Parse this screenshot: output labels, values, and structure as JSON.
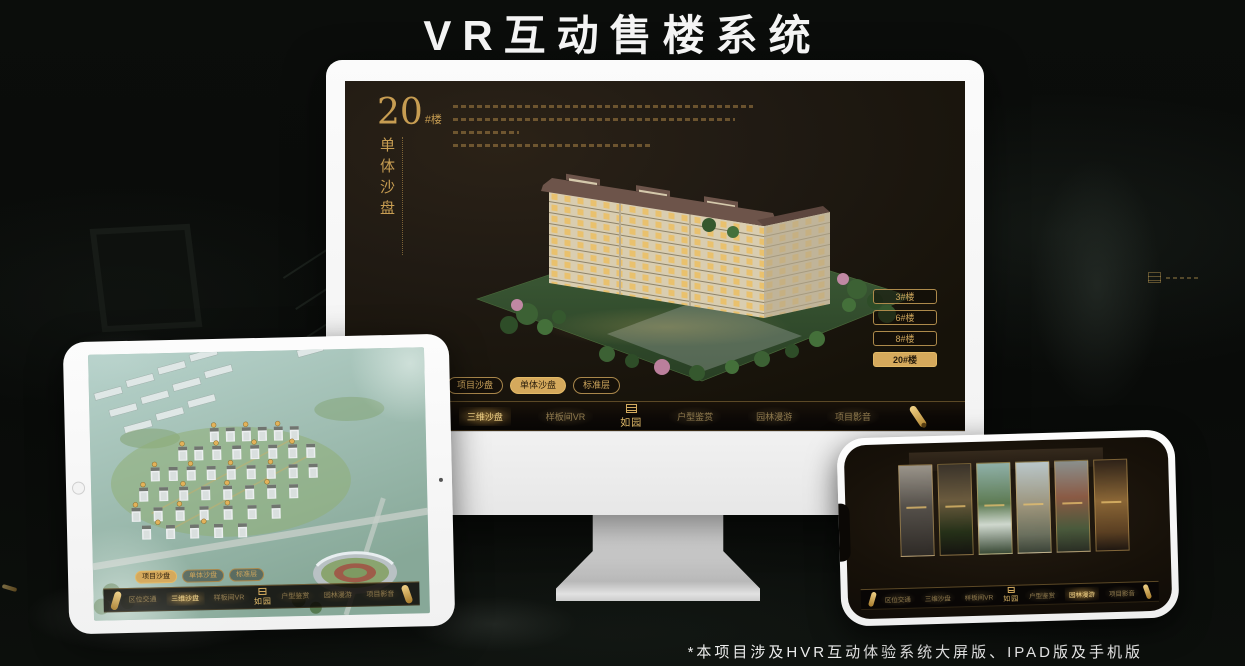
{
  "page": {
    "title": "VR互动售楼系统",
    "footer_note": "*本项目涉及HVR互动体验系统大屏版、IPAD版及手机版"
  },
  "brand": {
    "logo": "如园"
  },
  "nav": {
    "items": [
      "区位交通",
      "三维沙盘",
      "样板间VR",
      "户型鉴赏",
      "园林漫游",
      "项目影音"
    ],
    "monitor_selected": "三维沙盘",
    "ipad_selected": "三维沙盘",
    "phone_selected": "园林漫游"
  },
  "subnav": {
    "items": [
      "项目沙盘",
      "单体沙盘",
      "标准层"
    ],
    "monitor_selected": "单体沙盘",
    "ipad_selected": "项目沙盘"
  },
  "monitor_screen": {
    "building_number": "20",
    "building_number_suffix": "#楼",
    "panel_title": "单体沙盘",
    "floor_buttons": [
      {
        "label": "3#楼",
        "selected": false
      },
      {
        "label": "6#楼",
        "selected": false
      },
      {
        "label": "8#楼",
        "selected": false
      },
      {
        "label": "20#楼",
        "selected": true
      }
    ]
  },
  "icons": {
    "brand_seal": "seal-stamp",
    "nav_scroll": "gold-scroll",
    "ipad_home": "home-button"
  },
  "colors": {
    "gold": "#d3a95c",
    "gold_bright": "#f0d187",
    "screen_bg": "#1f1913",
    "page_bg": "#0a0c0a",
    "device_white": "#f7f7f7"
  }
}
